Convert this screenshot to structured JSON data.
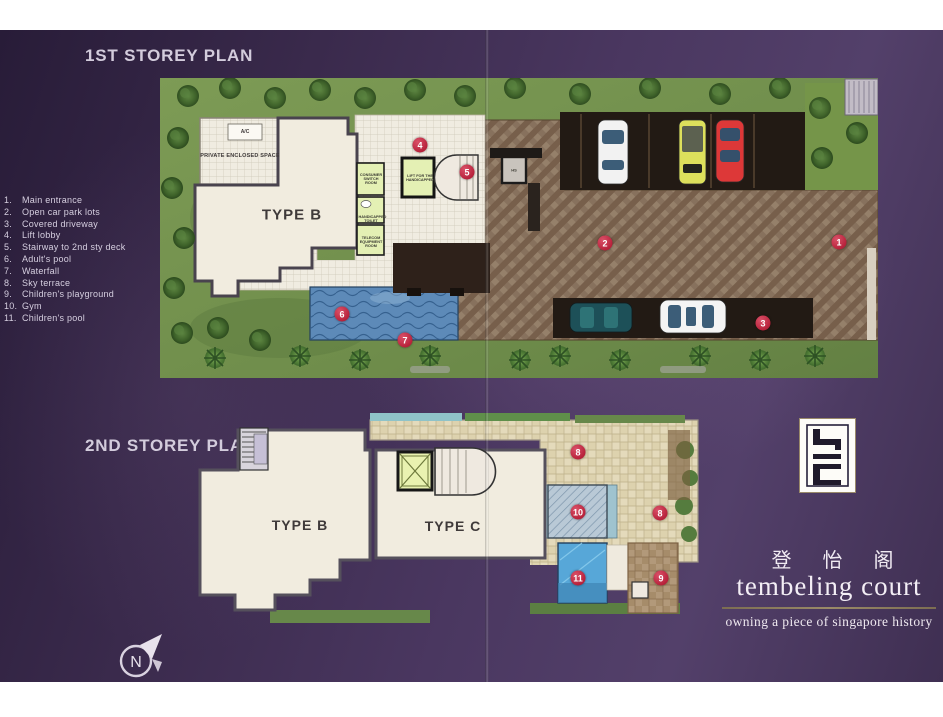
{
  "plan1": {
    "title": "1ST STOREY PLAN",
    "unit_label": "TYPE B",
    "labels": {
      "pes": "PRIVATE ENCLOSED SPACE",
      "ac": "A/C",
      "consumer": "CONSUMER SWITCH ROOM",
      "toilet": "HANDICAPPED TOILET",
      "telecom": "TELECOM EQUIPMENT ROOM",
      "lift_handicapped": "LIFT FOR THE HANDICAPPED",
      "hs": "HS"
    }
  },
  "plan2": {
    "title": "2ND STOREY PLAN",
    "unit_b_label": "TYPE B",
    "unit_c_label": "TYPE C"
  },
  "legend": {
    "items": [
      {
        "num": "1.",
        "label": "Main entrance"
      },
      {
        "num": "2.",
        "label": "Open car park lots"
      },
      {
        "num": "3.",
        "label": "Covered driveway"
      },
      {
        "num": "4.",
        "label": "Lift lobby"
      },
      {
        "num": "5.",
        "label": "Stairway to 2nd  sty deck"
      },
      {
        "num": "6.",
        "label": "Adult's pool"
      },
      {
        "num": "7.",
        "label": "Waterfall"
      },
      {
        "num": "8.",
        "label": "Sky terrace"
      },
      {
        "num": "9.",
        "label": "Children's  playground"
      },
      {
        "num": "10.",
        "label": "Gym"
      },
      {
        "num": "11.",
        "label": "Children's pool"
      }
    ]
  },
  "markers": {
    "m1": "1",
    "m2": "2",
    "m3": "3",
    "m4": "4",
    "m5": "5",
    "m6": "6",
    "m7": "7",
    "m8": "8",
    "m9": "9",
    "m10": "10",
    "m11": "11"
  },
  "branding": {
    "chinese": "登 怡 阁",
    "name": "tembeling court",
    "tagline": "owning a piece of singapore history"
  },
  "compass": {
    "label": "N"
  },
  "colors": {
    "background_purple": "#4a3760",
    "marker_red": "#c6304a",
    "grass_green": "#7a9a52",
    "pool_blue": "#5d8ab8",
    "driveway_brown": "#85705c",
    "building_cream": "#f1ecdf",
    "utility_room_green": "#e4f0b4",
    "terrace_beige": "#ddd2ae"
  }
}
